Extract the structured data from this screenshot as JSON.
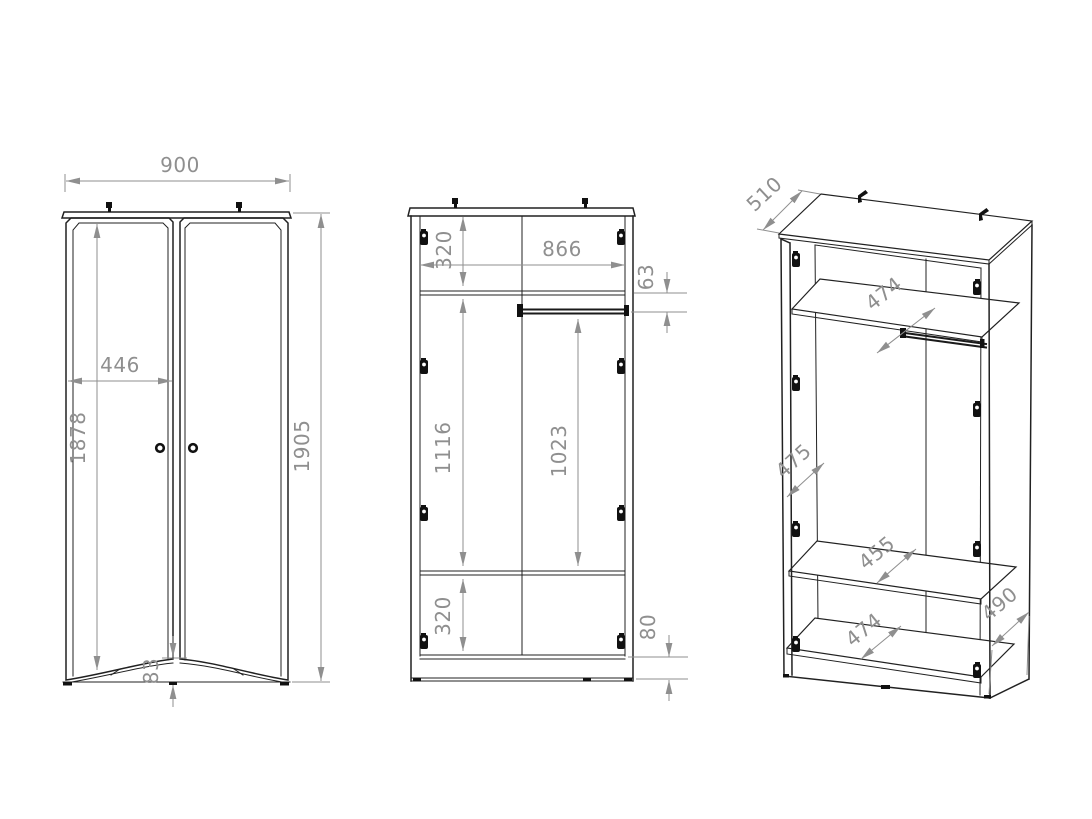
{
  "drawing": {
    "type": "furniture technical drawing",
    "subject": "two-door wardrobe dimension drawing",
    "background_color": "#ffffff",
    "outline_color": "#212121",
    "dimension_color": "#8f8f8f",
    "units": "mm",
    "views": {
      "front_closed": {
        "name": "front view with doors",
        "width": "900",
        "door_inner_width": "446",
        "door_height": "1878",
        "total_height": "1905",
        "base_curve_height": "83"
      },
      "front_open": {
        "name": "front section view (interior)",
        "top_compartment": "320",
        "interior_width": "866",
        "rail_offset": "63",
        "left_compartment_height": "1116",
        "hanging_clearance": "1023",
        "bottom_compartment": "320",
        "plinth_height": "80"
      },
      "isometric": {
        "name": "isometric interior view",
        "top_depth": "510",
        "top_shelf_depth": "474",
        "upper_side_depth": "475",
        "middle_shelf_depth": "455",
        "bottom_shelf_depth": "474",
        "lower_side_depth": "490"
      }
    }
  }
}
